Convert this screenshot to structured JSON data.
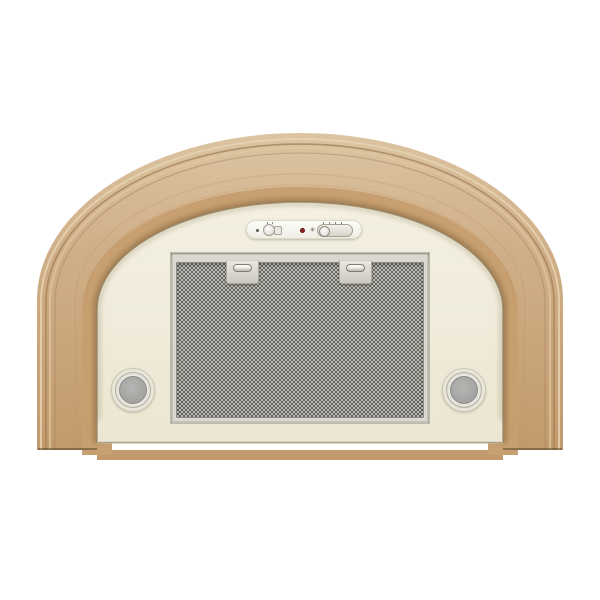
{
  "meta": {
    "type": "product-photo",
    "subject": "Built-in cooker hood with arched wooden trim",
    "background_color": "#ffffff"
  },
  "product": {
    "wood_frame": {
      "label": "wooden arch frame",
      "base_color": "#c9a172",
      "highlight_color": "#e4cfae",
      "groove_color": "#a07d52"
    },
    "body_panel": {
      "label": "cream enamel body panel",
      "color": "#f1ecdc"
    },
    "control_panel": {
      "label": "slide-switch control panel",
      "background": "#fbfaf5",
      "items": [
        {
          "icon": "lamp-dot-icon"
        },
        {
          "control": "light-slide-switch",
          "positions": 2
        },
        {
          "indicator": "power-indicator",
          "color": "#8e241e"
        },
        {
          "icon": "fan-icon",
          "glyph": "✳"
        },
        {
          "control": "fan-speed-slide-switch",
          "tick_marks": 4
        }
      ]
    },
    "grease_filter": {
      "label": "aluminium mesh grease filter",
      "mesh_dark": "#54544e",
      "mesh_light": "#c6c5c0",
      "frame_color": "#dad8d0",
      "clip_count": 2,
      "clip_label": "filter release clip"
    },
    "lamps": {
      "label": "round halogen lamp",
      "count": 2,
      "ring_color": "#f0eee7",
      "lens_color": "#a7a8a5"
    }
  }
}
